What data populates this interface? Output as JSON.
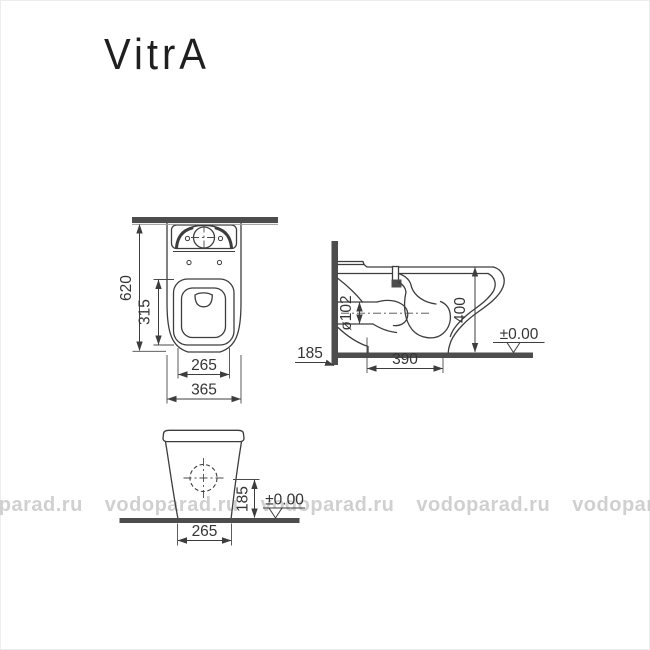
{
  "logo": "VitrA",
  "watermark": {
    "tiles": [
      "vodoparad.ru",
      "vodoparad.ru",
      "vodoparad.ru",
      "vodoparad.ru",
      "vodoparad.ru"
    ]
  },
  "plan_view": {
    "dim_total_depth": "620",
    "dim_inner_length": "315",
    "dim_inner_width": "265",
    "dim_overall_width": "365"
  },
  "side_view": {
    "dim_outlet_diameter": "ø102",
    "dim_rim_height": "400",
    "dim_outlet_height": "185",
    "dim_base_depth": "390",
    "datum_level": "±0.00"
  },
  "front_view": {
    "dim_outlet_height": "185",
    "datum_level": "±0.00",
    "dim_base_width": "265"
  }
}
